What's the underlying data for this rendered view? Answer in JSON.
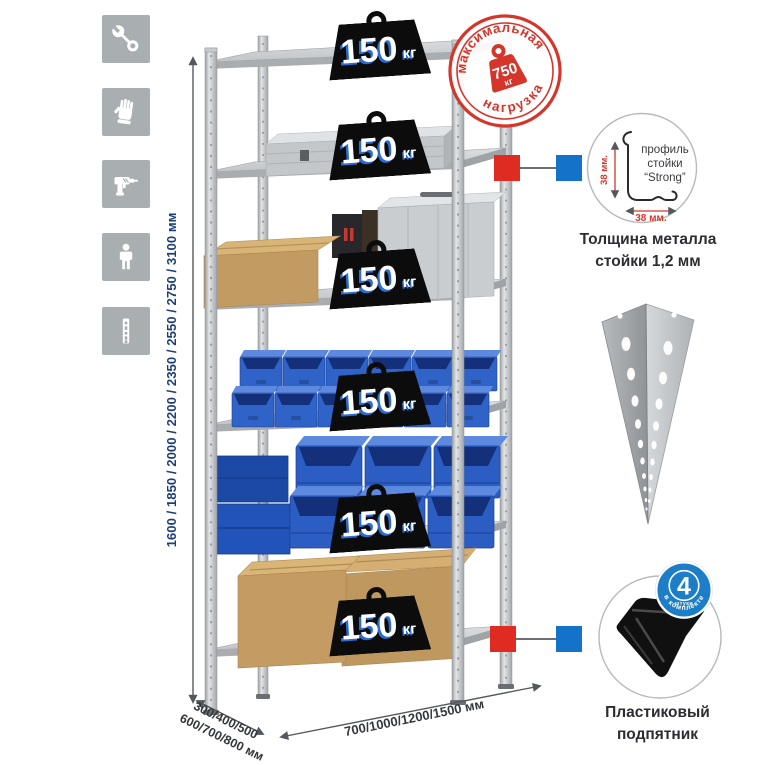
{
  "rack": {
    "weights": [
      {
        "value": "150",
        "unit": "кг"
      },
      {
        "value": "150",
        "unit": "кг"
      },
      {
        "value": "150",
        "unit": "кг"
      },
      {
        "value": "150",
        "unit": "кг"
      },
      {
        "value": "150",
        "unit": "кг"
      },
      {
        "value": "150",
        "unit": "кг"
      }
    ]
  },
  "stamp": {
    "top_text": "максимальная",
    "bottom_text": "нагрузка",
    "value": "750",
    "unit": "кг",
    "color": "#d5362c"
  },
  "dimensions": {
    "height": "1600 / 1850 / 2000 / 2200 / 2350 / 2550 / 2750 / 3100 мм",
    "depth_line1": "300/400/500",
    "depth_line2": "600/700/800 мм",
    "width": "700/1000/1200/1500 мм"
  },
  "profile_detail": {
    "label_line1": "профиль",
    "label_line2": "стойки",
    "label_line3": "“Strong”",
    "dim_v": "38 мм.",
    "dim_h": "38 мм.",
    "caption_line1": "Толщина металла",
    "caption_line2": "стойки 1,2 мм"
  },
  "foot_detail": {
    "badge_value": "4",
    "badge_sub": "штуки",
    "badge_ring_text": "в комплекте",
    "badge_color": "#1b7ec6",
    "caption_line1": "Пластиковый",
    "caption_line2": "подпятник"
  },
  "icons": {
    "items": [
      "wrench",
      "gloves",
      "drill",
      "person",
      "post-profile"
    ]
  },
  "colors": {
    "accent_red": "#d5362c",
    "accent_blue": "#1b7ec6",
    "dim_text": "#1d3f77",
    "metal": "#c8cbce",
    "bin_blue": "#2f63c8",
    "cardboard": "#c49c63"
  }
}
